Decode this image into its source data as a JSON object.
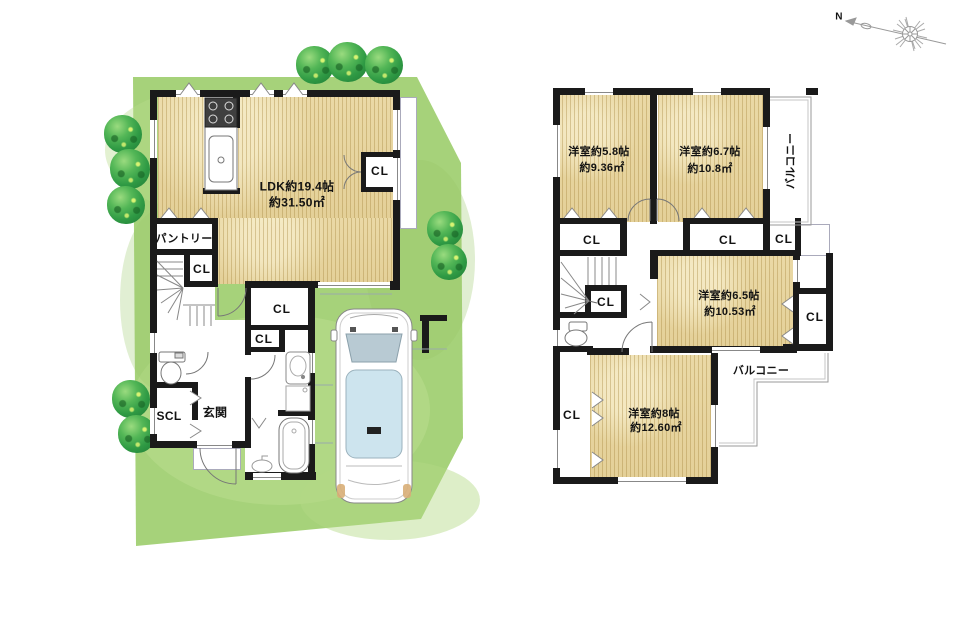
{
  "plan": {
    "floor1": {
      "ldk_name": "LDK約19.4帖",
      "ldk_area": "約31.50㎡",
      "pantry": "パントリー",
      "entrance": "玄関",
      "shoe_closet": "SCL"
    },
    "floor2": {
      "rooms": [
        {
          "name": "洋室約5.8帖",
          "area": "約9.36㎡"
        },
        {
          "name": "洋室約6.7帖",
          "area": "約10.8㎡"
        },
        {
          "name": "洋室約6.5帖",
          "area": "約10.53㎡"
        },
        {
          "name": "洋室約8帖",
          "area": "約12.60㎡"
        }
      ],
      "balcony_upper": "バルコニー",
      "balcony_lower": "バルコニー"
    },
    "closet_label": "CL",
    "compass_north": "N",
    "colors": {
      "site_green": "#a6d27a",
      "floor_wood": "#e8d7a2",
      "wall_black": "#1a1a1a",
      "car_glass": "#cde4ee",
      "tree_green": "#2f9a44"
    }
  }
}
